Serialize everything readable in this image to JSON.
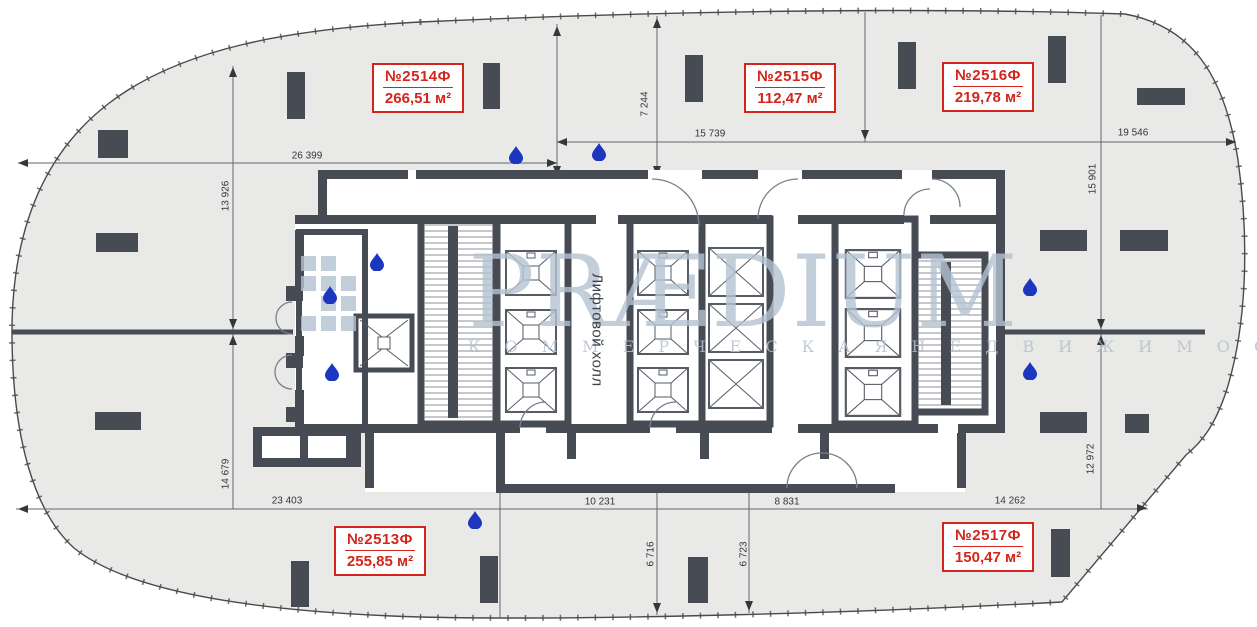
{
  "watermark": {
    "brand": "PRÆDIUM",
    "tagline": "К О М М Е Р Ч Е С К А Я   Н Е Д В И Ж И М О С Т Ь"
  },
  "core": {
    "elevator_hall": "Лифтовой холл"
  },
  "units": [
    {
      "id": "2514",
      "number": "№2514Ф",
      "area": "266,51 м²"
    },
    {
      "id": "2515",
      "number": "№2515Ф",
      "area": "112,47 м²"
    },
    {
      "id": "2516",
      "number": "№2516Ф",
      "area": "219,78 м²"
    },
    {
      "id": "2513",
      "number": "№2513Ф",
      "area": "255,85 м²"
    },
    {
      "id": "2517",
      "number": "№2517Ф",
      "area": "150,47 м²"
    }
  ],
  "dimensions": {
    "top_left_width": "26 399",
    "left_upper_height": "13 926",
    "top_center_offset": "7 244",
    "top_center_width": "15 739",
    "top_right_width": "19 546",
    "right_upper_height": "15 901",
    "left_lower_height": "14 679",
    "bottom_left_width": "23 403",
    "bottom_center_left_width": "10 231",
    "bottom_center_right_width": "8 831",
    "bottom_right_width": "14 262",
    "right_lower_height": "12 972",
    "bottom_inner_left_height": "6 716",
    "bottom_inner_right_height": "6 723"
  },
  "colors": {
    "accent_red": "#d3251c",
    "wall_dark": "#474b54",
    "floor_fill": "#e9e9e7",
    "watermark_blue": "#b5c2d3",
    "water_drop_blue": "#1c36c0"
  }
}
